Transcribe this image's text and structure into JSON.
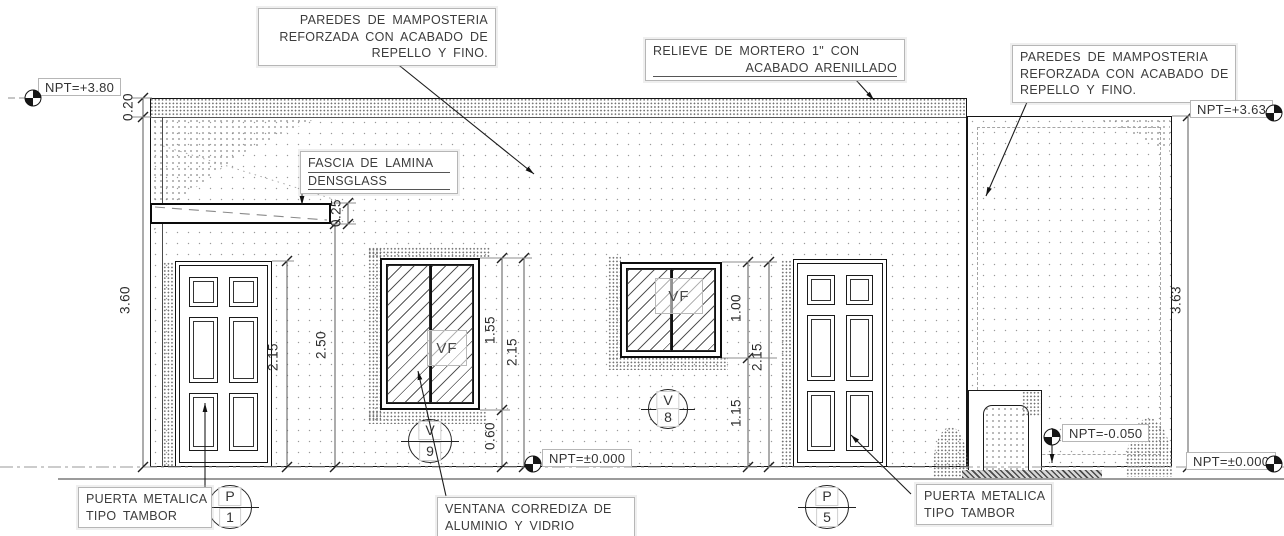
{
  "drawing": {
    "kind": "architectural front elevation",
    "colors": {
      "line": "#141414",
      "dim_line": "#5a5a5a",
      "text": "#3c3c3c",
      "note_box_border": "#b6b6b6",
      "stipple": "#8a8a8a"
    }
  },
  "notes": {
    "masonry_left": {
      "line1": "PAREDES DE MAMPOSTERIA",
      "line2": "REFORZADA CON ACABADO DE",
      "line3": "REPELLO Y FINO."
    },
    "mortar": {
      "line1": "RELIEVE DE MORTERO 1\" CON",
      "line2": "ACABADO ARENILLADO"
    },
    "masonry_right": {
      "line1": "PAREDES DE MAMPOSTERIA",
      "line2": "REFORZADA CON ACABADO DE",
      "line3": "REPELLO Y FINO."
    },
    "fascia": {
      "line1": "FASCIA DE LAMINA",
      "line2": "DENSGLASS"
    },
    "door_left": {
      "line1": "PUERTA METALICA",
      "line2": "TIPO TAMBOR"
    },
    "door_right": {
      "line1": "PUERTA METALICA",
      "line2": "TIPO TAMBOR"
    },
    "window_sliding": {
      "line1": "VENTANA CORREDIZA DE",
      "line2": "ALUMINIO Y VIDRIO"
    }
  },
  "levels": {
    "npt_plus_380": "NPT=+3.80",
    "npt_plus_363": "NPT=+3.63",
    "npt_zero_center": "NPT=±0.000",
    "npt_zero_right": "NPT=±0.000",
    "npt_minus_050": "NPT=-0.050"
  },
  "dimensions": {
    "parapet_band": "0.20",
    "left_wall_height": "3.60",
    "left_door_height": "2.15",
    "canopy_to_floor": "2.50",
    "fascia_thickness": "0.25",
    "window_v9_height": "1.55",
    "window_v9_head": "2.15",
    "window_v9_sill": "0.60",
    "window_v8_height": "1.00",
    "window_v8_head": "2.15",
    "window_v8_sill": "1.15",
    "right_wall_height": "3.63"
  },
  "markers": {
    "v9": {
      "letter": "V",
      "number": "9"
    },
    "v8": {
      "letter": "V",
      "number": "8"
    },
    "p1": {
      "letter": "P",
      "number": "1"
    },
    "p5": {
      "letter": "P",
      "number": "5"
    }
  },
  "tags": {
    "vf_v9": "VF",
    "vf_v8": "VF"
  }
}
